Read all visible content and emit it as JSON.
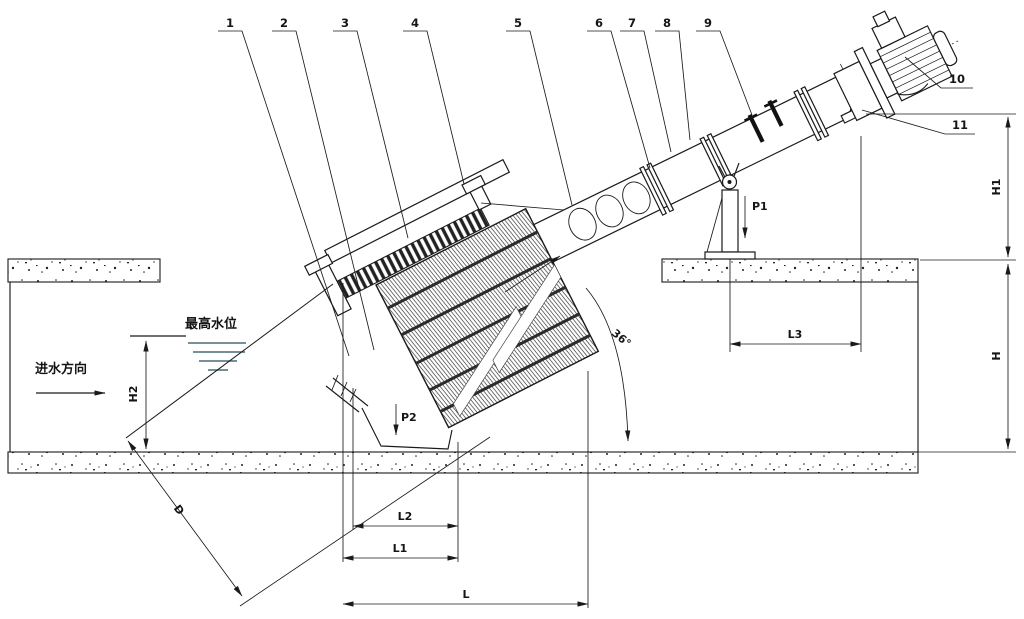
{
  "callouts": [
    "1",
    "2",
    "3",
    "4",
    "5",
    "6",
    "7",
    "8",
    "9",
    "10",
    "11"
  ],
  "labels": {
    "max_water_level": "最高水位",
    "inflow_direction": "进水方向"
  },
  "dimensions": {
    "H1": "H1",
    "H": "H",
    "H2": "H2",
    "L": "L",
    "L1": "L1",
    "L2": "L2",
    "L3": "L3",
    "D": "D",
    "P1": "P1",
    "P2": "P2",
    "angle": "36°"
  },
  "colors": {
    "line": "#1a1a1a",
    "background": "#ffffff"
  }
}
